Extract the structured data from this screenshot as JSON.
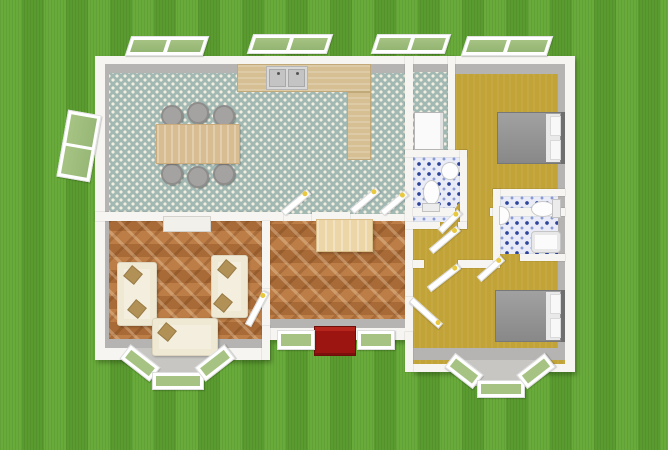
{
  "scene": {
    "label": "3D top-view floor plan of a single-storey house on a lawn",
    "canvas": {
      "width": 668,
      "height": 450
    }
  },
  "colors": {
    "grass1": "#68ab3a",
    "grass2": "#5a9b30",
    "wall": "#f6f5f1",
    "shade": "#b5b4b2",
    "kitchenFloor": "#a2b8b3",
    "kitchenDot": "#f2efe0",
    "olive": "#c2a337",
    "wood1": "#bd7d46",
    "wood2": "#a86a36",
    "tileBase": "#e9ecf6",
    "tileBlue": "#2e459e",
    "counter": "#d6bf92",
    "table": "#d9bd92",
    "chair": "#a5a3a1",
    "sofa": "#f3eedd",
    "pillow": "#b29157",
    "bedGray": "#949494",
    "matRed": "#9c1511",
    "glass": "#a6c383",
    "handle": "#e7c83e"
  },
  "rooms": {
    "kitchen_dining": {
      "label": "Kitchen / Dining room",
      "floor": "teal dotted tile"
    },
    "utility": {
      "label": "Utility room",
      "floor": "teal dotted tile"
    },
    "bedroom_top": {
      "label": "Bedroom 1",
      "floor": "olive"
    },
    "wc": {
      "label": "WC",
      "floor": "blue mosaic tile"
    },
    "bathroom": {
      "label": "Bathroom",
      "floor": "blue mosaic tile"
    },
    "living": {
      "label": "Living room",
      "floor": "herringbone parquet"
    },
    "hall": {
      "label": "Entrance hall",
      "floor": "herringbone parquet"
    },
    "corridor": {
      "label": "Corridor",
      "floor": "olive"
    },
    "bedroom_bottom": {
      "label": "Bedroom 2",
      "floor": "olive"
    }
  },
  "furniture": {
    "dining_table": {
      "label": "Dining table",
      "chairs": 6
    },
    "dining_chair": {
      "label": "Dining chair"
    },
    "kitchen_counter": {
      "label": "L-shaped kitchen counter"
    },
    "kitchen_sink": {
      "label": "Double kitchen sink"
    },
    "refrigerator": {
      "label": "Refrigerator"
    },
    "bed_top": {
      "label": "Double bed with gray cover"
    },
    "bed_bottom": {
      "label": "Double bed with gray cover"
    },
    "sofa_left": {
      "label": "Cream sofa"
    },
    "sofa_right": {
      "label": "Cream sofa"
    },
    "sofa_bottom": {
      "label": "Cream sofa"
    },
    "throw_pillow": {
      "label": "Throw pillow"
    },
    "tv_cabinet": {
      "label": "Low cabinet"
    },
    "hall_desk": {
      "label": "Console table"
    },
    "wc_toilet": {
      "label": "Toilet"
    },
    "wc_sink": {
      "label": "Round washbasin"
    },
    "bath_toilet": {
      "label": "Toilet"
    },
    "bath_sink": {
      "label": "Wall washbasin"
    },
    "bathtub": {
      "label": "Bathtub"
    },
    "door_mat": {
      "label": "Red entrance mat"
    }
  },
  "openings": {
    "entry": {
      "label": "Front entrance with red mat"
    },
    "door_leaf": {
      "label": "Open interior door"
    },
    "window_top": {
      "label": "Awning window (open)"
    },
    "window_left": {
      "label": "Casement window (open)"
    },
    "bay_window": {
      "label": "Bay window"
    },
    "entrance_window": {
      "label": "Entrance side window"
    }
  }
}
